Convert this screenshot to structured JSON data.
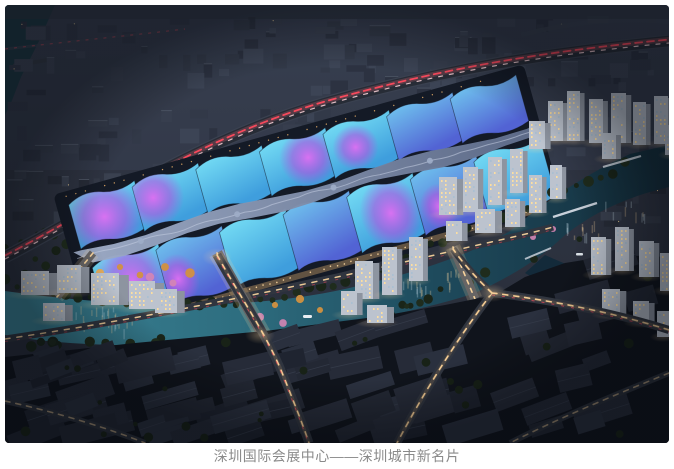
{
  "figure": {
    "alt": "深圳国际会展中心夜景鸟瞰效果图",
    "caption": "深圳国际会展中心——深圳城市新名片",
    "caption_color": "#8a8a8a"
  },
  "scene": {
    "description": "Night aerial rendering: exhibition halls with wavy roofs glowing cyan and magenta along a central spine, elevated highway with red light trails behind, teal river with bridges in front, warm-lit residential towers at right, dark urban-village blocks in the foreground crossed by glowing roads",
    "landmarks": [
      "exhibition-halls",
      "central-spine",
      "highway",
      "river",
      "bridges",
      "towers",
      "urban-village",
      "light-trails",
      "parking-lot"
    ],
    "palette": {
      "sky_top": "#343a4a",
      "sky_bottom": "#262b36",
      "haze": "rgba(72,84,112,0.16)",
      "building_fills": [
        "#343a48",
        "#2e3441",
        "#3a4150",
        "#272c38"
      ],
      "building_top": "#4a5160",
      "tree_dark": "#1f2c1d",
      "tree_dark2": "#1a2519",
      "tree_orange": "#d2913f",
      "tree_orange2": "#e8ab55",
      "tree_pink": "#d585b4",
      "canal": "#16333c",
      "river_1": "#3b8294",
      "river_2": "#2e6e80",
      "river_3": "#1e4a5c",
      "river_4": "#142e3c",
      "branch_water": "#132a3a",
      "highway": "#272c36",
      "highway_edge": "#3a4150",
      "trail_red": "#ff4a5e",
      "trail_red_glow": "#ff7080",
      "trail_white": "#ffd6da",
      "trail_warm": "#ffd9a0",
      "trail_warm2": "#ffbe6e",
      "road_dark": "#30353f",
      "road_faint": "#2b303a",
      "roof_cyan_a": "#74dcf4",
      "roof_cyan_b": "#3f9edd",
      "roof_blue_a": "#6fc2ee",
      "roof_blue_b": "#5263d4",
      "roof_magenta": "#df6ef2",
      "roof_magenta_deep": "#b253e0",
      "spine_a": "#9fadc8",
      "spine_b": "#5e6c8a",
      "spine_ridge": "#c6d0e4",
      "complex_base": "#141a26",
      "facade": "#6a5a46",
      "tower_face": "#bcc3ce",
      "tower_side": "#8d94a0",
      "window_warm": "#ffdf9e",
      "window_cool": "#a9c0d2",
      "village_ground": "#10141c",
      "village_roofs": [
        "#1f2430",
        "#262b38",
        "#232834",
        "#2a303e"
      ],
      "village_ridge": "#3a4150",
      "bridge_deck": "#454c58",
      "footbridge": "#d2d9e2",
      "parking": "#3e444e",
      "car_dot": "#d3dae1",
      "vignette": "rgba(4,7,13,0.38)"
    }
  }
}
